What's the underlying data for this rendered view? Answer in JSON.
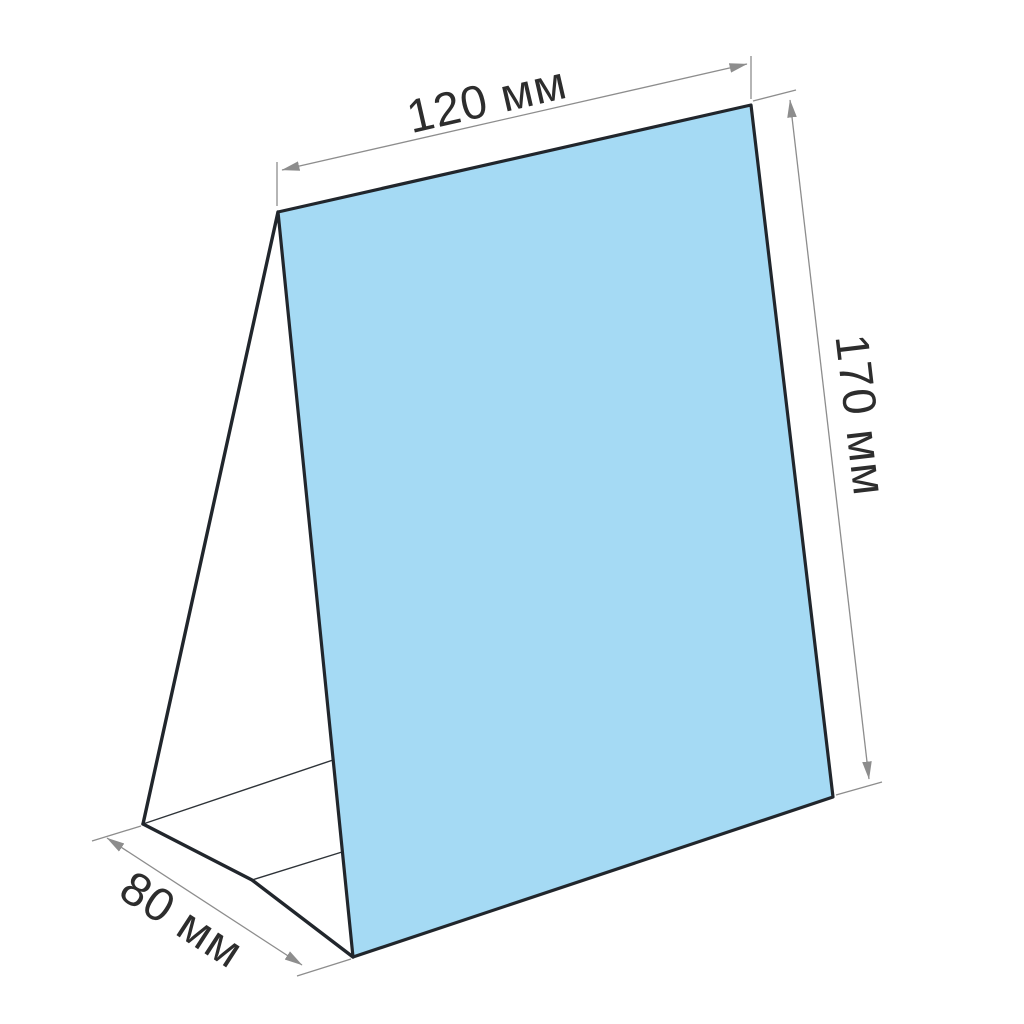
{
  "diagram": {
    "type": "product-dimension-drawing",
    "subject": "table-tent-card",
    "labels": {
      "width": "120 мм",
      "height": "170 мм",
      "depth": "80 мм"
    },
    "dimensions_mm": {
      "width": 120,
      "height": 170,
      "depth": 80
    },
    "unit": "мм",
    "colors": {
      "background": "#ffffff",
      "panel_fill": "#a5daf4",
      "outline": "#21262c",
      "fold_line": "#2e3338",
      "dimension": "#8d8d8d",
      "label_text": "#2d2d2d"
    }
  }
}
